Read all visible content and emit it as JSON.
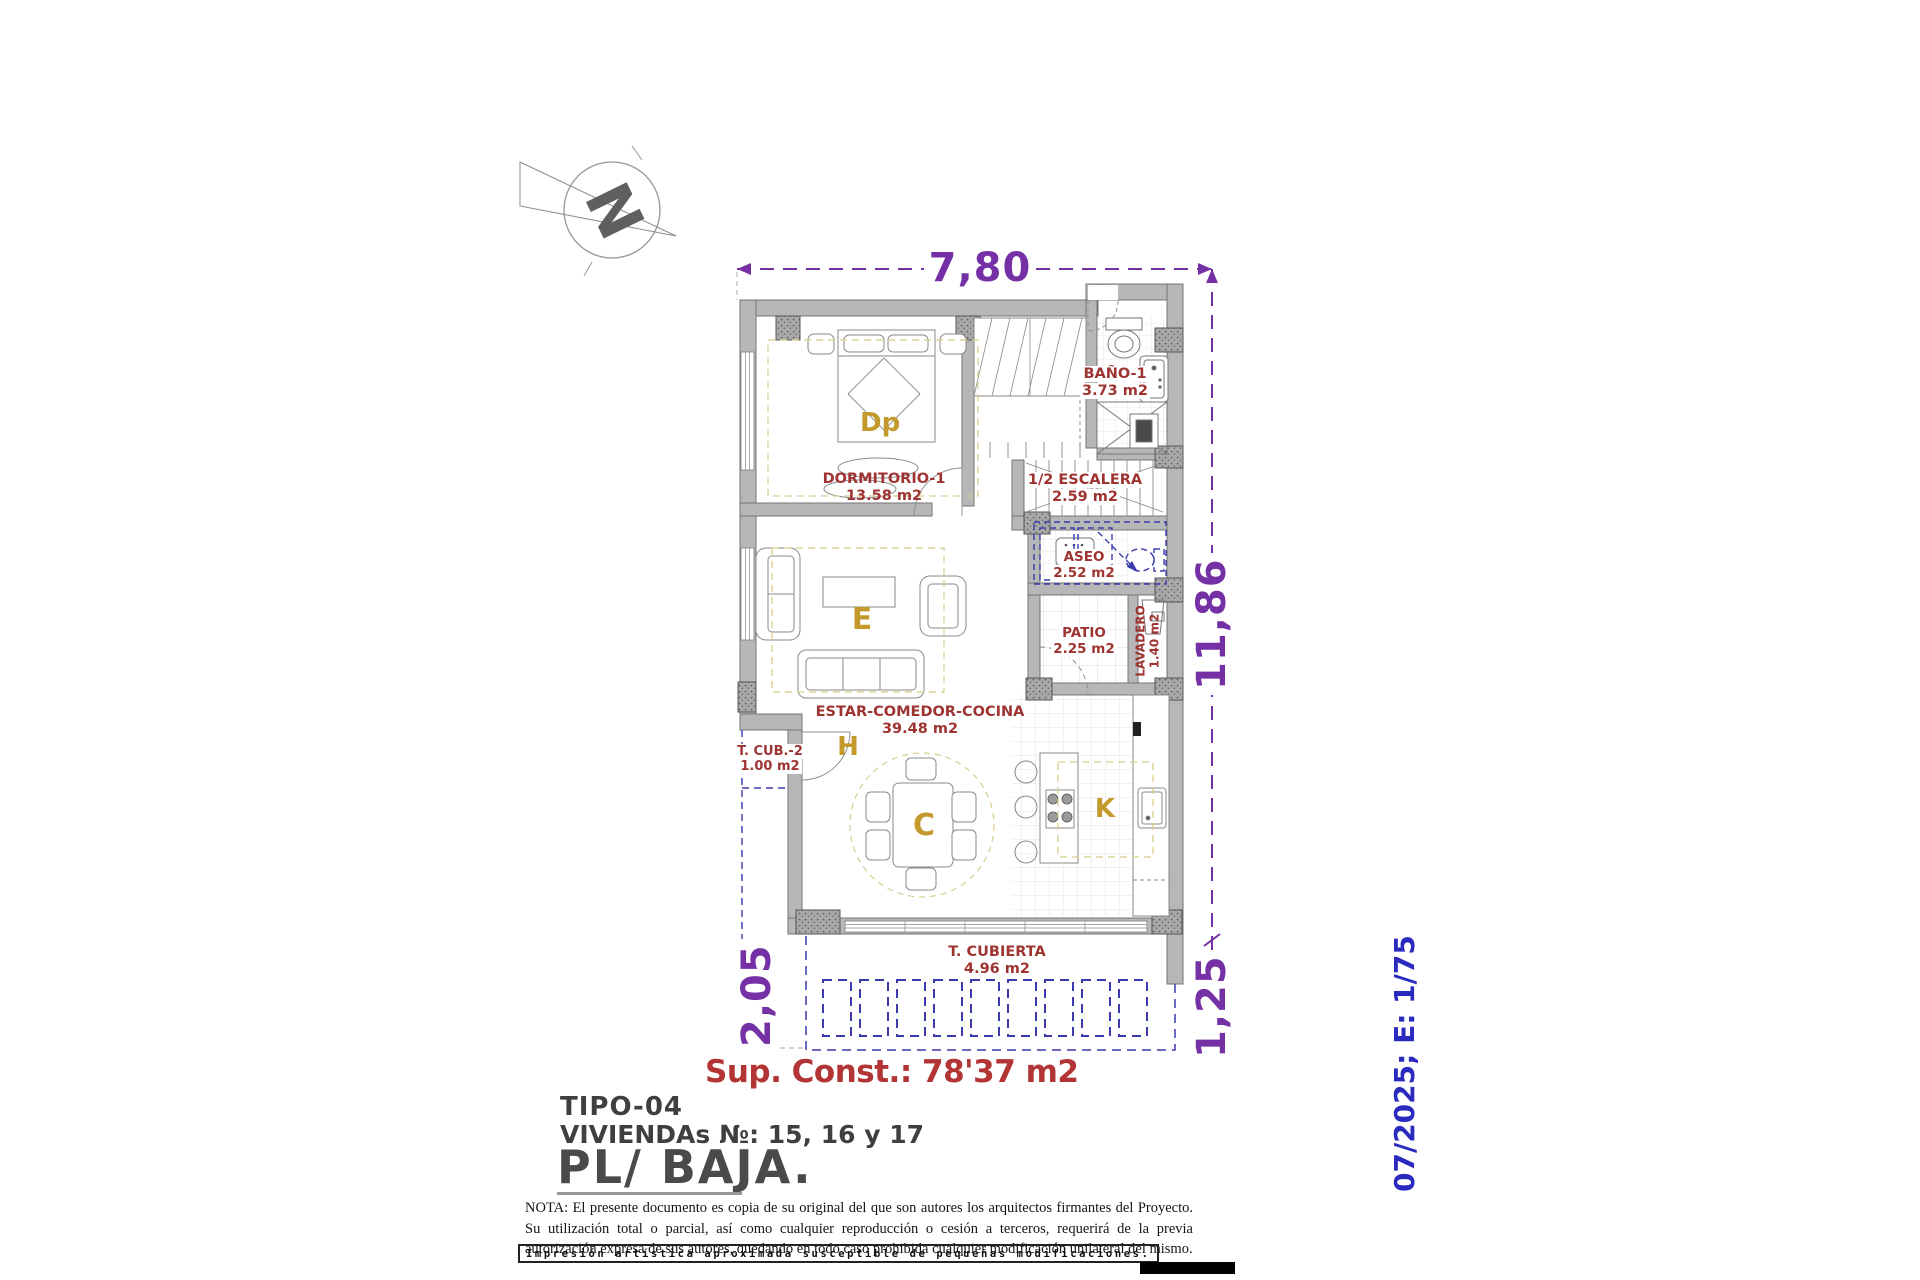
{
  "compass": {
    "letter": "N"
  },
  "plan": {
    "dimensions": {
      "width_top": "7,80",
      "height_right": "11,86",
      "terrace_left": "2,05",
      "terrace_right": "1,25"
    },
    "rooms": {
      "dormitorio": {
        "name": "DORMITORIO-1",
        "area": "13.58 m2"
      },
      "bano": {
        "name": "BAÑO-1",
        "area": "3.73 m2"
      },
      "escalera": {
        "name": "1/2 ESCALERA",
        "area": "2.59 m2"
      },
      "aseo": {
        "name": "ASEO",
        "area": "2.52 m2"
      },
      "patio": {
        "name": "PATIO",
        "area": "2.25 m2"
      },
      "lavadero": {
        "name": "LAVADERO",
        "area": "1.40 m2"
      },
      "estar": {
        "name": "ESTAR-COMEDOR-COCINA",
        "area": "39.48 m2"
      },
      "tcub2": {
        "name": "T. CUB.-2",
        "area": "1.00 m2"
      },
      "tcubierta": {
        "name": "T. CUBIERTA",
        "area": "4.96 m2"
      }
    },
    "letters": {
      "bedroom": "Dp",
      "living": "E",
      "hall": "H",
      "dining": "C",
      "kitchen": "K"
    },
    "summary": "Sup. Const.: 78'37 m2"
  },
  "title_block": {
    "tipo": "TIPO-04",
    "viviendas": "VIVIENDAs №: 15, 16 y 17",
    "planta": "PL/ BAJA."
  },
  "stamp": "07/2025; E: 1/75",
  "note": "NOTA: El presente documento es copia de su original del que son autores los arquitectos firmantes del Proyecto. Su utilización total o parcial, así como cualquier reproducción o cesión a terceros, requerirá de la previa autorización expresa de sus autores, quedando en todo caso prohibida cualquier modificación unilateral del mismo.",
  "disclaimer": "Impresión artística aproximada susceptible de pequeñas modificaciones.",
  "colors": {
    "wall": "#b7b7b7",
    "dimension_purple": "#7430a4",
    "room_label_red": "#9e3432",
    "room_letter_gold": "#c2992a",
    "projection_blue": "#3a3aae",
    "stamp_blue": "#2a2abf",
    "summary_red": "#b23434",
    "zone_yellow": "#d8cd8e"
  }
}
